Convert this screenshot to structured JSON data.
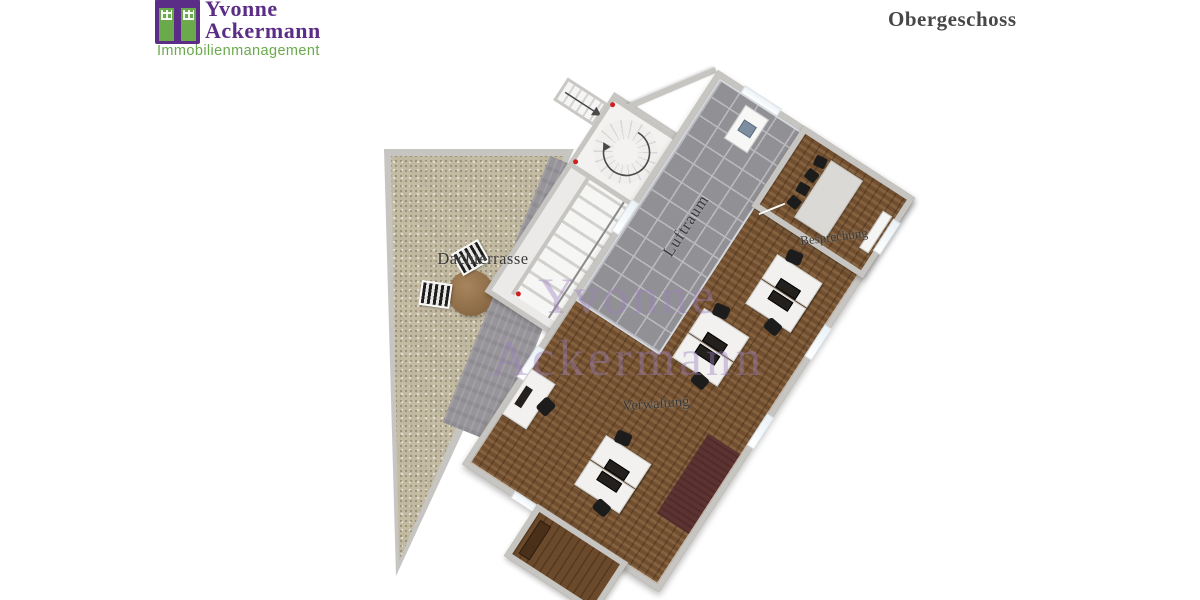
{
  "header": {
    "logo": {
      "icon": "building-door-icon",
      "line1": "Yvonne",
      "line2": "Ackermann",
      "tagline": "Immobilienmanagement"
    },
    "title": "Obergeschoss"
  },
  "plan": {
    "rotation_deg": 33,
    "walkway_rotation_deg": 22,
    "watermark": {
      "line1": "Yvonne",
      "line2": "Ackermann"
    },
    "rooms": [
      {
        "id": "dachterrasse",
        "label": "Dachterrasse",
        "floor": "gravel terrace"
      },
      {
        "id": "luftraum",
        "label": "Luftraum",
        "floor": "gray tiles"
      },
      {
        "id": "besprechung",
        "label": "Besprechung",
        "floor": "wood"
      },
      {
        "id": "verwaltung",
        "label": "Verwaltung",
        "floor": "wood"
      }
    ],
    "features": {
      "spiral_staircase": {
        "icon": "curved-arrow",
        "location": "stairwell annex"
      },
      "straight_staircase": {
        "treads": 10,
        "railing": true
      },
      "exit_stair": {
        "icon": "straight-arrow"
      },
      "door_markers": {
        "icon": "red-dot",
        "count": 3
      },
      "windows": "light strips on exterior walls"
    },
    "furniture": {
      "terrace": {
        "round_table": 1,
        "striped_loungers": 2
      },
      "besprechung": {
        "conference_table": 1,
        "black_chairs": 4,
        "sideboard": 1
      },
      "verwaltung": {
        "desk_pairs": 3,
        "wall_desk": 1,
        "monitors": 7,
        "black_chairs": 7,
        "dark_rug": 1
      },
      "bottom_wing": {
        "sideboard": 1
      },
      "luftraum": {
        "wall_fixture": 1
      }
    }
  },
  "colors": {
    "logo_purple": "#5b2d86",
    "logo_green": "#6aa94c",
    "title_color": "#474747",
    "label": "#3a3a3a",
    "terrace": "#cdc4ac",
    "walkway": "#97959a",
    "wall": "#c6c5c1",
    "wood": "#7b5836",
    "wing_wood": "#6b4a2c",
    "tiles": "#909095",
    "tile_grout": "#b8b8bd",
    "table": "#dbd9d5",
    "chair": "#1c1c1c",
    "rug": "#5d3332",
    "door_marker": "#cc2020",
    "watermark": "rgba(158,128,190,0.42)"
  }
}
